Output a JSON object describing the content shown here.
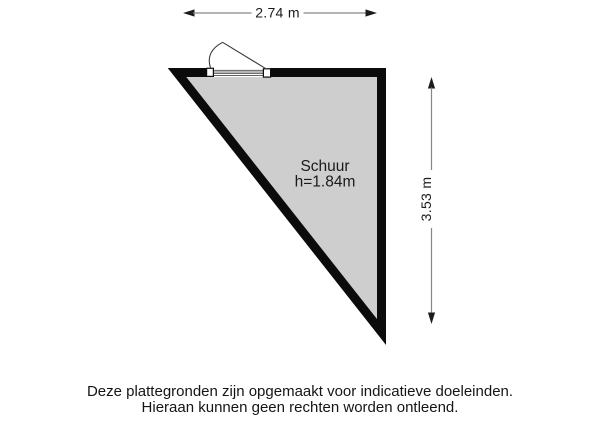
{
  "plan": {
    "room": {
      "name": "Schuur",
      "height_label": "h=1.84m"
    },
    "dimensions": {
      "top_width": "2.74 m",
      "right_height": "3.53 m"
    }
  },
  "disclaimer": {
    "line1": "Deze plattegronden zijn opgemaakt voor indicatieve doeleinden.",
    "line2": "Hieraan kunnen geen rechten worden ontleend."
  },
  "colors": {
    "wall": "#0b0b0b",
    "floor": "#cecece",
    "dimension_line": "#868686",
    "arrow": "#1c1c1c",
    "text": "#1a1a1a",
    "door": "#3c3c3c"
  }
}
